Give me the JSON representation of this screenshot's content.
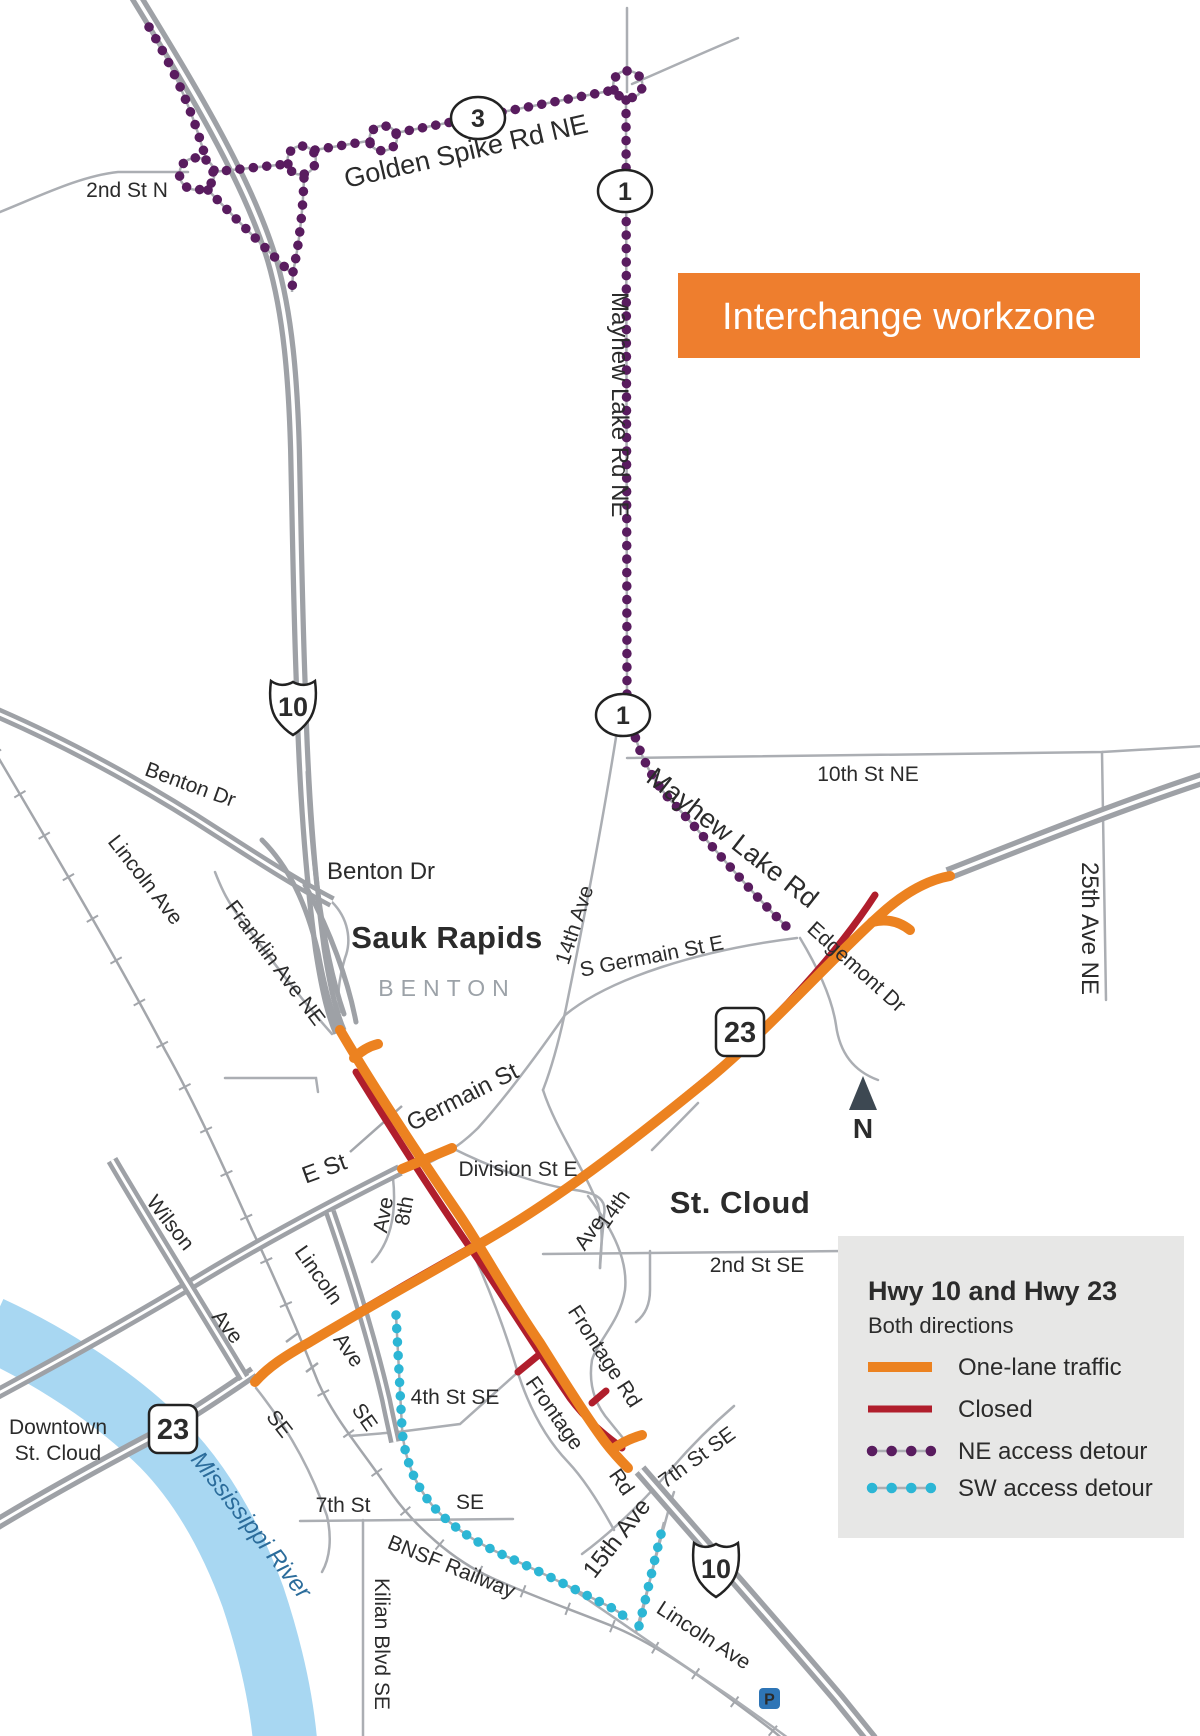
{
  "banner": {
    "label": "Interchange workzone"
  },
  "legend": {
    "title": "Hwy 10 and Hwy 23",
    "subtitle": "Both directions",
    "items": [
      {
        "label": "One-lane traffic",
        "style": "solid",
        "color": "#EC8220"
      },
      {
        "label": "Closed",
        "style": "solid",
        "color": "#B01E2C"
      },
      {
        "label": "NE access detour",
        "style": "dotted",
        "color": "#591C5F"
      },
      {
        "label": "SW access detour",
        "style": "dotted",
        "color": "#2CB6D5"
      }
    ]
  },
  "markers": {
    "route3": "3",
    "route1_top": "1",
    "route1_mid": "1",
    "us10_north": "10",
    "us10_south": "10",
    "mn23_northeast": "23",
    "mn23_southwest": "23",
    "parking": "P",
    "north": "N"
  },
  "labels": {
    "second_st_n": "2nd St N",
    "golden_spike": "Golden Spike Rd NE",
    "mayhew_ne": "Mayhew Lake Rd NE",
    "tenth_st_ne": "10th St NE",
    "twenty_fifth_ave": "25th Ave NE",
    "mayhew_lake_rd": "Mayhew Lake Rd",
    "edgemont_dr": "Edgemont Dr",
    "s_germain": "S Germain St E",
    "benton_dr_w": "Benton Dr",
    "benton_dr_e": "Benton Dr",
    "lincoln_ave_nw": "Lincoln Ave",
    "franklin_ave": "Franklin  Ave NE",
    "sauk_rapids": "Sauk Rapids",
    "benton_county": "BENTON",
    "fourteenth_ave_n": "14th Ave",
    "germain_st": "Germain St",
    "division_st_e": "Division St E",
    "e_st": "E  St",
    "eighth_ave_num": "8th",
    "eighth_ave_word": "Ave",
    "wilson": "Wilson",
    "wilson_ave": "Ave",
    "wilson_se": "SE",
    "lincoln_mid": "Lincoln",
    "lincoln_mid_ave": "Ave",
    "lincoln_mid_se": "SE",
    "st_cloud": "St. Cloud",
    "fourteenth_s_num": "14th",
    "fourteenth_s_word": "Ave",
    "second_st_se": "2nd St SE",
    "frontage_rd_e": "Frontage Rd",
    "frontage_w": "Frontage",
    "frontage_w_rd": "Rd",
    "fourth_st_se": "4th St SE",
    "downtown_line1": "Downtown",
    "downtown_line2": "St. Cloud",
    "mississippi": "Mississippi River",
    "seventh_st": "7th St",
    "seventh_st_suffix": "SE",
    "bnsf": "BNSF Railway",
    "kilian": "Kilian Blvd SE",
    "fifteenth_ave": "15th Ave",
    "seventh_st_se": "7th St SE",
    "lincoln_bottom": "Lincoln Ave"
  },
  "colors": {
    "orange": "#EC8220",
    "banner-orange": "#EE7E2E",
    "closed-red": "#B01E2C",
    "ne-purple": "#591C5F",
    "sw-cyan": "#2CB6D5",
    "river": "#A8D7F2",
    "road-gray": "#9EA1A6",
    "thin-road": "#ABAEB3",
    "rail": "#A3A6AB",
    "label-dark": "#2B2B2B",
    "county-gray": "#9CA2A8",
    "river-text": "#2B6C9B",
    "legend-bg": "#E7E7E6",
    "arrow": "#3D4852",
    "parking-blue": "#2E75B6"
  }
}
